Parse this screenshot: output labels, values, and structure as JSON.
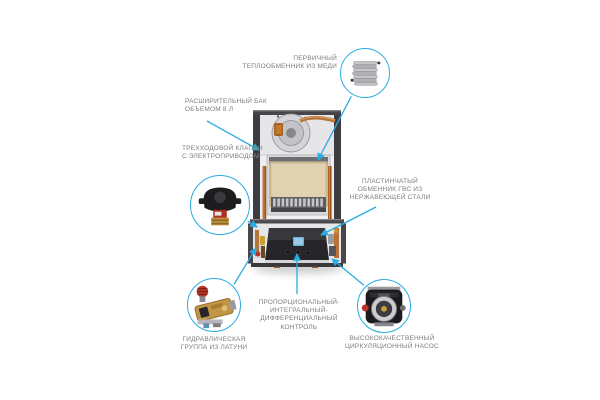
{
  "accent_color": "#2aabe2",
  "label_color": "#7b7d80",
  "callouts": {
    "primary_heat_exchanger": {
      "label": "ПЕРВИЧНЫЙ\nТЕПЛООБМЕННИК ИЗ МЕДИ",
      "thumbnail": "copper-finned-heat-exchanger-photo"
    },
    "expansion_tank": {
      "label": "РАСШИРИТЕЛЬНЫЙ БАК\nОБЪЕМОМ 8 Л"
    },
    "three_way_valve": {
      "label": "ТРЕХХОДОВОЙ КЛАПАН\nС ЭЛЕКТРОПРИВОДОМ",
      "thumbnail": "motorized-three-way-valve-photo"
    },
    "plate_exchanger": {
      "label": "ПЛАСТИНЧАТЫЙ\nОБМЕННИК ГВС ИЗ\nНЕРЖАВЕЮЩЕЙ СТАЛИ"
    },
    "hydraulic_group": {
      "label": "ГИДРАВЛИЧЕСКАЯ\nГРУППА ИЗ ЛАТУНИ",
      "thumbnail": "brass-hydraulic-group-photo"
    },
    "pid_control": {
      "label": "ПРОПОРЦИОНАЛЬНЫЙ-\nИНТЕГРАЛЬНЫЙ-\nДИФФЕРЕНЦИАЛЬНЫЙ\nКОНТРОЛЬ"
    },
    "circulation_pump": {
      "label": "ВЫСОКОКАЧЕСТВЕННЫЙ\nЦИРКУЛЯЦИОННЫЙ НАСОС",
      "thumbnail": "circulation-pump-photo"
    }
  }
}
